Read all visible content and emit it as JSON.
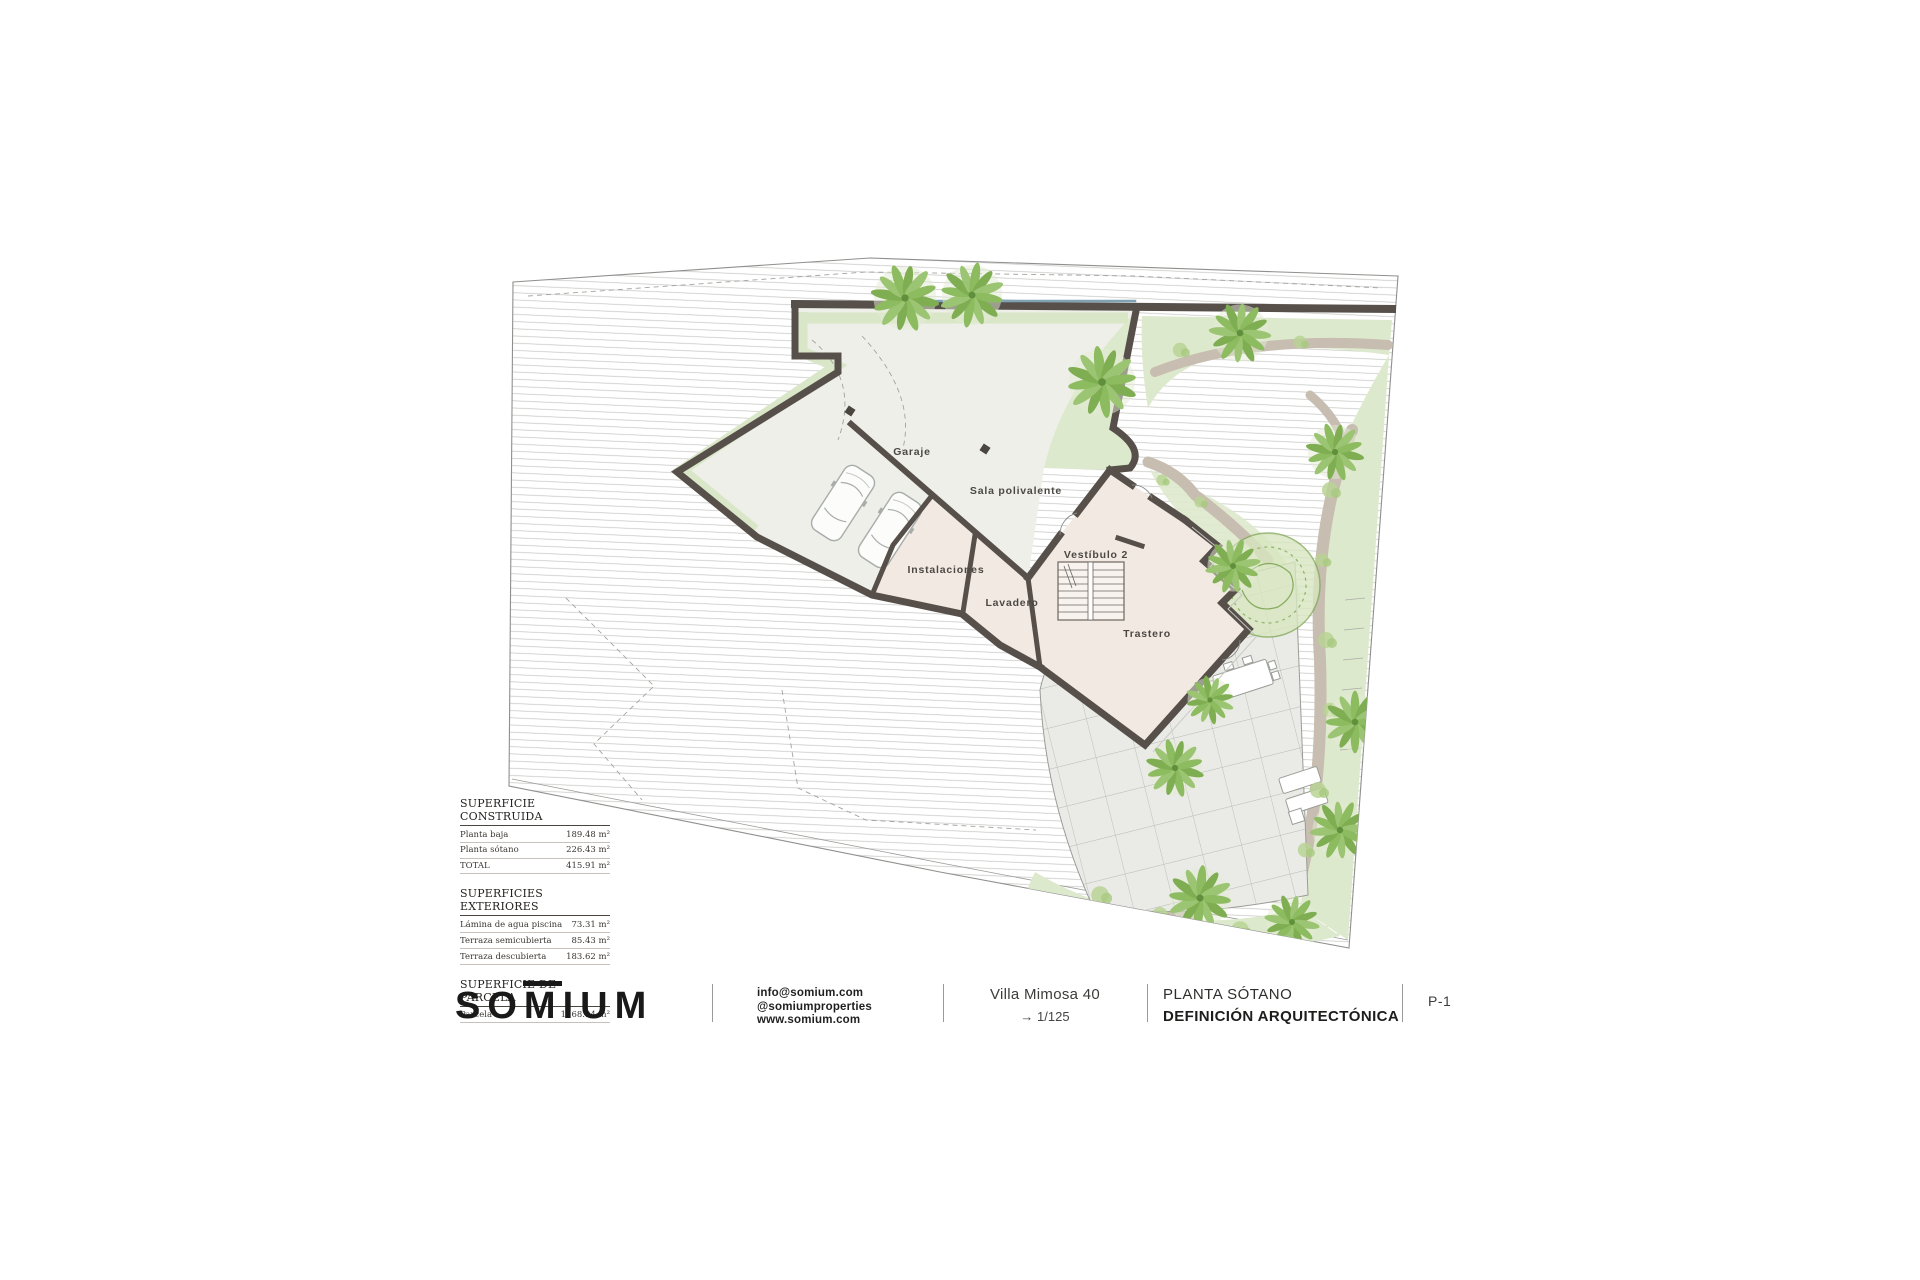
{
  "plan": {
    "rooms": {
      "garaje": "Garaje",
      "sala": "Sala polivalente",
      "instalaciones": "Instalaciones",
      "lavadero": "Lavadero",
      "vestibulo": "Vestíbulo 2",
      "trastero": "Trastero"
    },
    "colors": {
      "wall": "#57504a",
      "garage_fill": "#edefe8",
      "room_fill": "#f3e9e3",
      "garden_green": "#dde9cc",
      "palm_green": "#7fae52",
      "path_beige": "#c7bdb0",
      "terrace_grey": "#eaebe7",
      "hatch_grey": "#c6c6c3"
    }
  },
  "tables": [
    {
      "title": "SUPERFICIE CONSTRUIDA",
      "rows": [
        {
          "label": "Planta baja",
          "value": "189.48 m²"
        },
        {
          "label": "Planta sótano",
          "value": "226.43 m²"
        },
        {
          "label": "TOTAL",
          "value": "415.91 m²"
        }
      ]
    },
    {
      "title": "SUPERFICIES EXTERIORES",
      "rows": [
        {
          "label": "Lámina de agua piscina",
          "value": "73.31 m²"
        },
        {
          "label": "Terraza semicubierta",
          "value": "85.43 m²"
        },
        {
          "label": "Terraza descubierta",
          "value": "183.62 m²"
        }
      ]
    },
    {
      "title": "SUPERFICIE DE PARCELA",
      "rows": [
        {
          "label": "Parcela",
          "value": "1168.94 m²"
        }
      ]
    }
  ],
  "title_block": {
    "logo_prefix": "SO",
    "logo_m": "M",
    "logo_suffix": "IUM",
    "contact_line1": "info@somium.com",
    "contact_line2": "@somiumproperties",
    "contact_line3": "www.somium.com",
    "project_name": "Villa Mimosa 40",
    "scale_arrow": "→",
    "scale": "1/125",
    "plan_title": "PLANTA SÓTANO",
    "plan_subtitle": "DEFINICIÓN ARQUITECTÓNICA",
    "sheet_number": "P-1"
  }
}
